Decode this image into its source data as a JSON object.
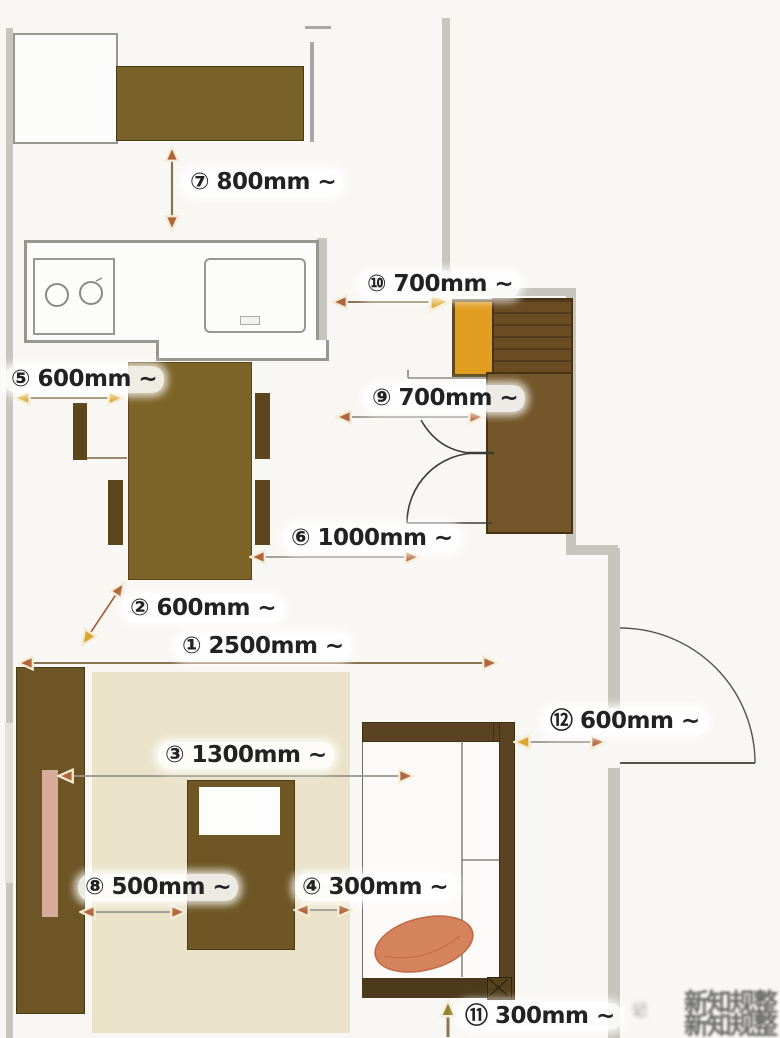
{
  "diagram": {
    "type": "floor-plan-clearance-diagram",
    "description": "apartment furniture layout with recommended clearance dimensions"
  },
  "dims": [
    {
      "num": "①",
      "value": "2500mm",
      "label": "① 2500mm ~"
    },
    {
      "num": "②",
      "value": "600mm",
      "label": "② 600mm ~"
    },
    {
      "num": "③",
      "value": "1300mm",
      "label": "③ 1300mm ~"
    },
    {
      "num": "④",
      "value": "300mm",
      "label": "④ 300mm ~"
    },
    {
      "num": "⑤",
      "value": "600mm",
      "label": "⑤ 600mm ~"
    },
    {
      "num": "⑥",
      "value": "1000mm",
      "label": "⑥ 1000mm ~"
    },
    {
      "num": "⑦",
      "value": "800mm",
      "label": "⑦ 800mm ~"
    },
    {
      "num": "⑧",
      "value": "500mm",
      "label": "⑧ 500mm ~"
    },
    {
      "num": "⑨",
      "value": "700mm",
      "label": "⑨ 700mm ~"
    },
    {
      "num": "⑩",
      "value": "700mm",
      "label": "⑩ 700mm ~"
    },
    {
      "num": "⑪",
      "value": "300mm",
      "label": "⑪ 300mm ~"
    },
    {
      "num": "⑫",
      "value": "600mm",
      "label": "⑫ 600mm ~"
    }
  ],
  "watermark": {
    "line1": "新知规整",
    "line2": "新知规整",
    "stamp": "记"
  },
  "colors": {
    "furniture_brown": "#79612a",
    "dark_brown": "#5a4322",
    "rug_beige": "#eae3c9",
    "pillow_orange": "#d5835d",
    "appliance_orange": "#e19d20",
    "wall_gray": "#c6c6be",
    "arrow_rust": "#b2653a",
    "arrow_gold": "#d9a62c",
    "arrow_olive": "#93802a",
    "tv_panel_pink": "#d7ab9b"
  }
}
